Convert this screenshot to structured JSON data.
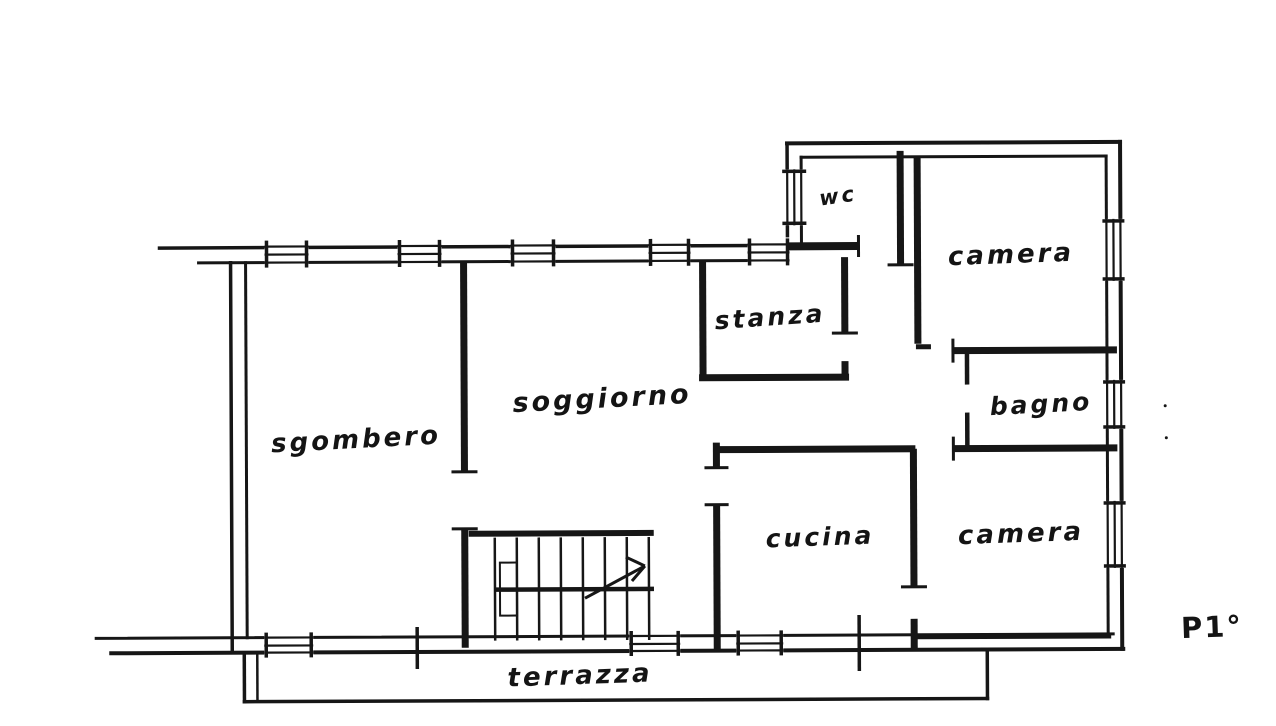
{
  "document": {
    "kind": "hand-drawn apartment floor plan scan",
    "floor_label": "P1°"
  },
  "colors": {
    "ink": "#161616",
    "paper": "#ffffff"
  },
  "rooms": [
    {
      "id": "sgombero",
      "label": "sgombero",
      "x": 356,
      "y": 440,
      "size": 26,
      "rot": -3
    },
    {
      "id": "soggiorno",
      "label": "soggiorno",
      "x": 602,
      "y": 399,
      "size": 27,
      "rot": -3
    },
    {
      "id": "stanza",
      "label": "stanza",
      "x": 770,
      "y": 317,
      "size": 25,
      "rot": -4
    },
    {
      "id": "wc",
      "label": "wc",
      "x": 838,
      "y": 196,
      "size": 21,
      "rot": -8
    },
    {
      "id": "camera-nord",
      "label": "camera",
      "x": 1011,
      "y": 255,
      "size": 26,
      "rot": -2
    },
    {
      "id": "bagno",
      "label": "bagno",
      "x": 1041,
      "y": 404,
      "size": 25,
      "rot": -3
    },
    {
      "id": "cucina",
      "label": "cucina",
      "x": 820,
      "y": 537,
      "size": 25,
      "rot": -2
    },
    {
      "id": "camera-sud",
      "label": "camera",
      "x": 1021,
      "y": 534,
      "size": 26,
      "rot": -2
    },
    {
      "id": "terrazza",
      "label": "terrazza",
      "x": 580,
      "y": 676,
      "size": 26,
      "rot": -2
    }
  ]
}
